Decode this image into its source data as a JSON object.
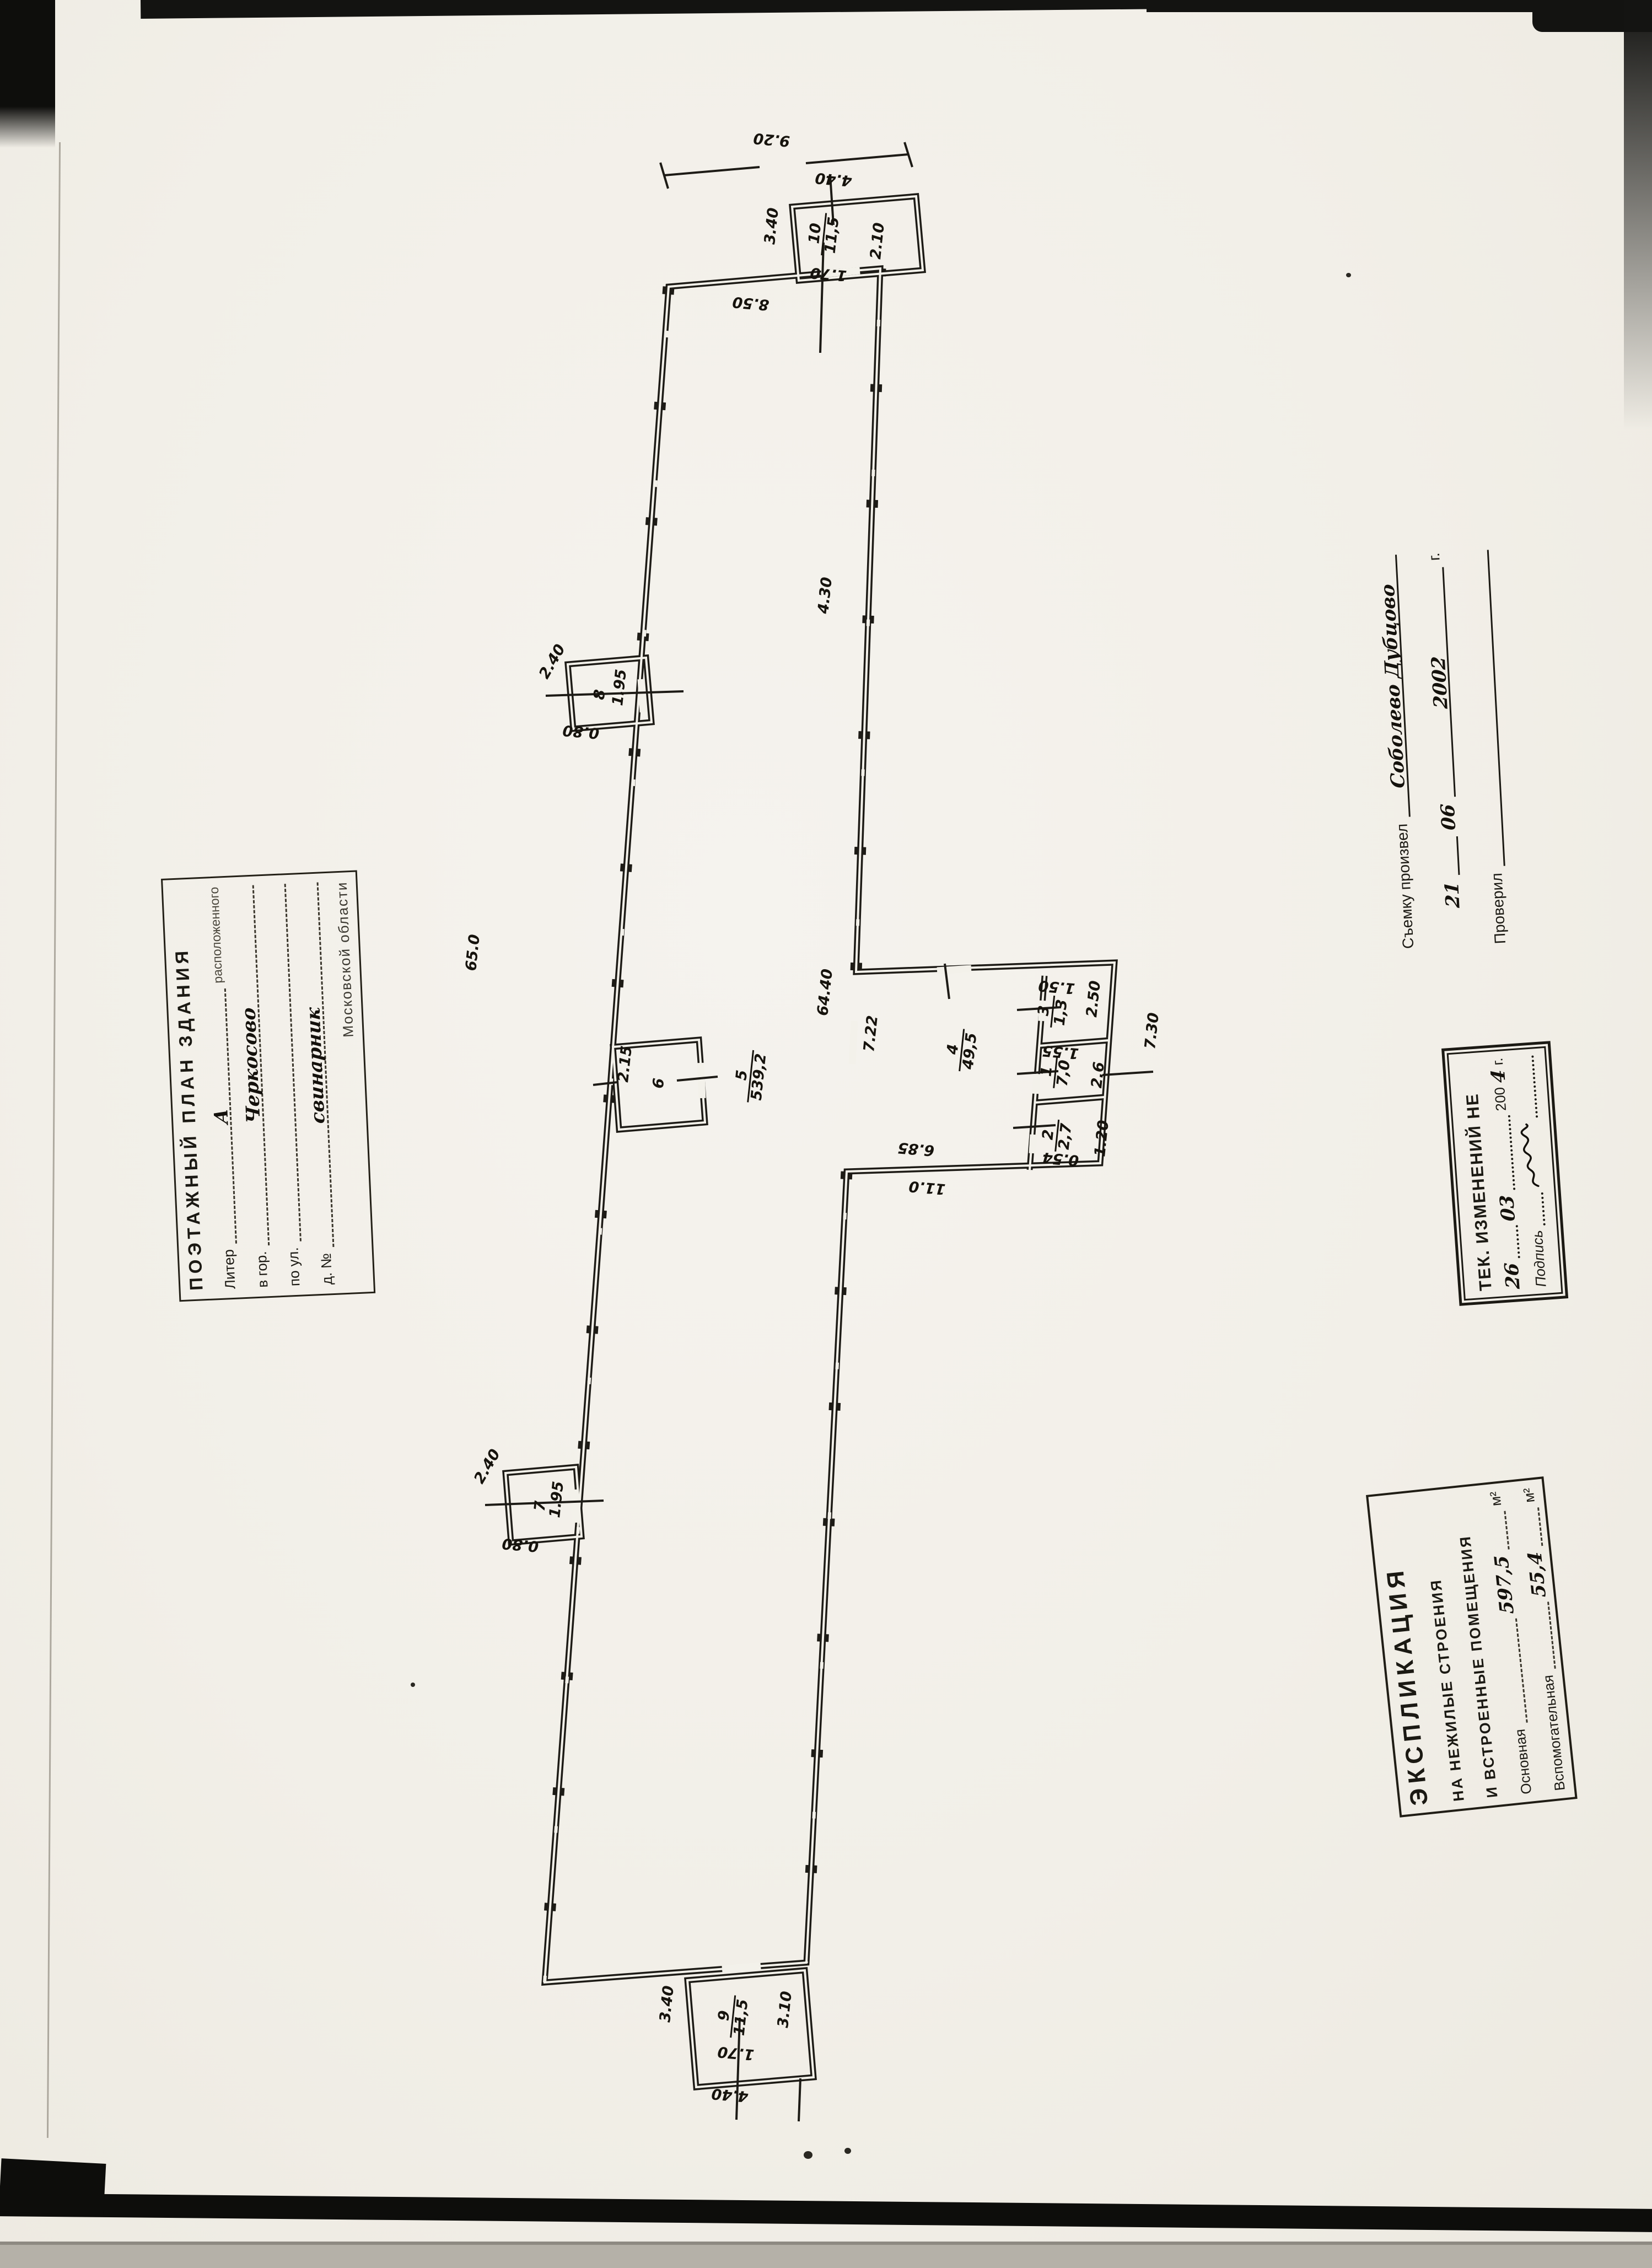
{
  "title_stamp": {
    "title": "ПОЭТАЖНЫЙ ПЛАН ЗДАНИЯ",
    "subtitle": "расположенного",
    "fields": [
      {
        "label": "Литер",
        "value": "А"
      },
      {
        "label": "в гор.",
        "value": "Черкосово"
      },
      {
        "label": "по ул.",
        "value": ""
      },
      {
        "label": "д. №",
        "value": "свинарник"
      }
    ],
    "region": "Московской области"
  },
  "survey_block": {
    "produced_label": "Съемку произвел",
    "produced_value": "Соболево Дубцово",
    "date_day": "21",
    "date_month": "06",
    "date_year": "2002",
    "year_suffix": "г.",
    "checked_label": "Проверил"
  },
  "changes_stamp": {
    "title": "ТЕК. ИЗМЕНЕНИЙ НЕ",
    "date_day": "26",
    "date_month": "03",
    "year_printed": "200",
    "year_hand": "4",
    "year_suffix": "г.",
    "signature_label": "Подпись"
  },
  "explication_stamp": {
    "title": "ЭКСПЛИКАЦИЯ",
    "line2": "НА НЕЖИЛЫЕ СТРОЕНИЯ",
    "line3": "И ВСТРОЕННЫЕ ПОМЕЩЕНИЯ",
    "rows": [
      {
        "label": "Основная",
        "value": "597,5",
        "unit": "м²"
      },
      {
        "label": "Вспомогательная",
        "value": "55,4",
        "unit": "м²"
      }
    ]
  },
  "plan": {
    "rooms": [
      {
        "number": "10",
        "area": "11,5"
      },
      {
        "number": "9",
        "area": "11,5"
      },
      {
        "number": "5",
        "area": "539,2"
      },
      {
        "number": "4",
        "area": "49,5"
      },
      {
        "number": "3",
        "area": "1,3"
      },
      {
        "number": "1",
        "area": "7,0"
      },
      {
        "number": "2",
        "area": "2,7"
      },
      {
        "number": "6"
      },
      {
        "number": "7"
      },
      {
        "number": "8"
      }
    ],
    "dims": [
      "9.20",
      "4.40",
      "3.40",
      "2.10",
      "1.70",
      "8.50",
      "4.30",
      "65.0",
      "64.40",
      "7.22",
      "7.30",
      "2.50",
      "2.6",
      "1.20",
      "1.50",
      "1.55",
      "0.54",
      "6.85",
      "11.0",
      "2.15",
      "2.40",
      "1.95",
      "0.80",
      "2.40",
      "1.95",
      "0.80",
      "3.40",
      "3.10",
      "1.70",
      "4.40"
    ]
  }
}
